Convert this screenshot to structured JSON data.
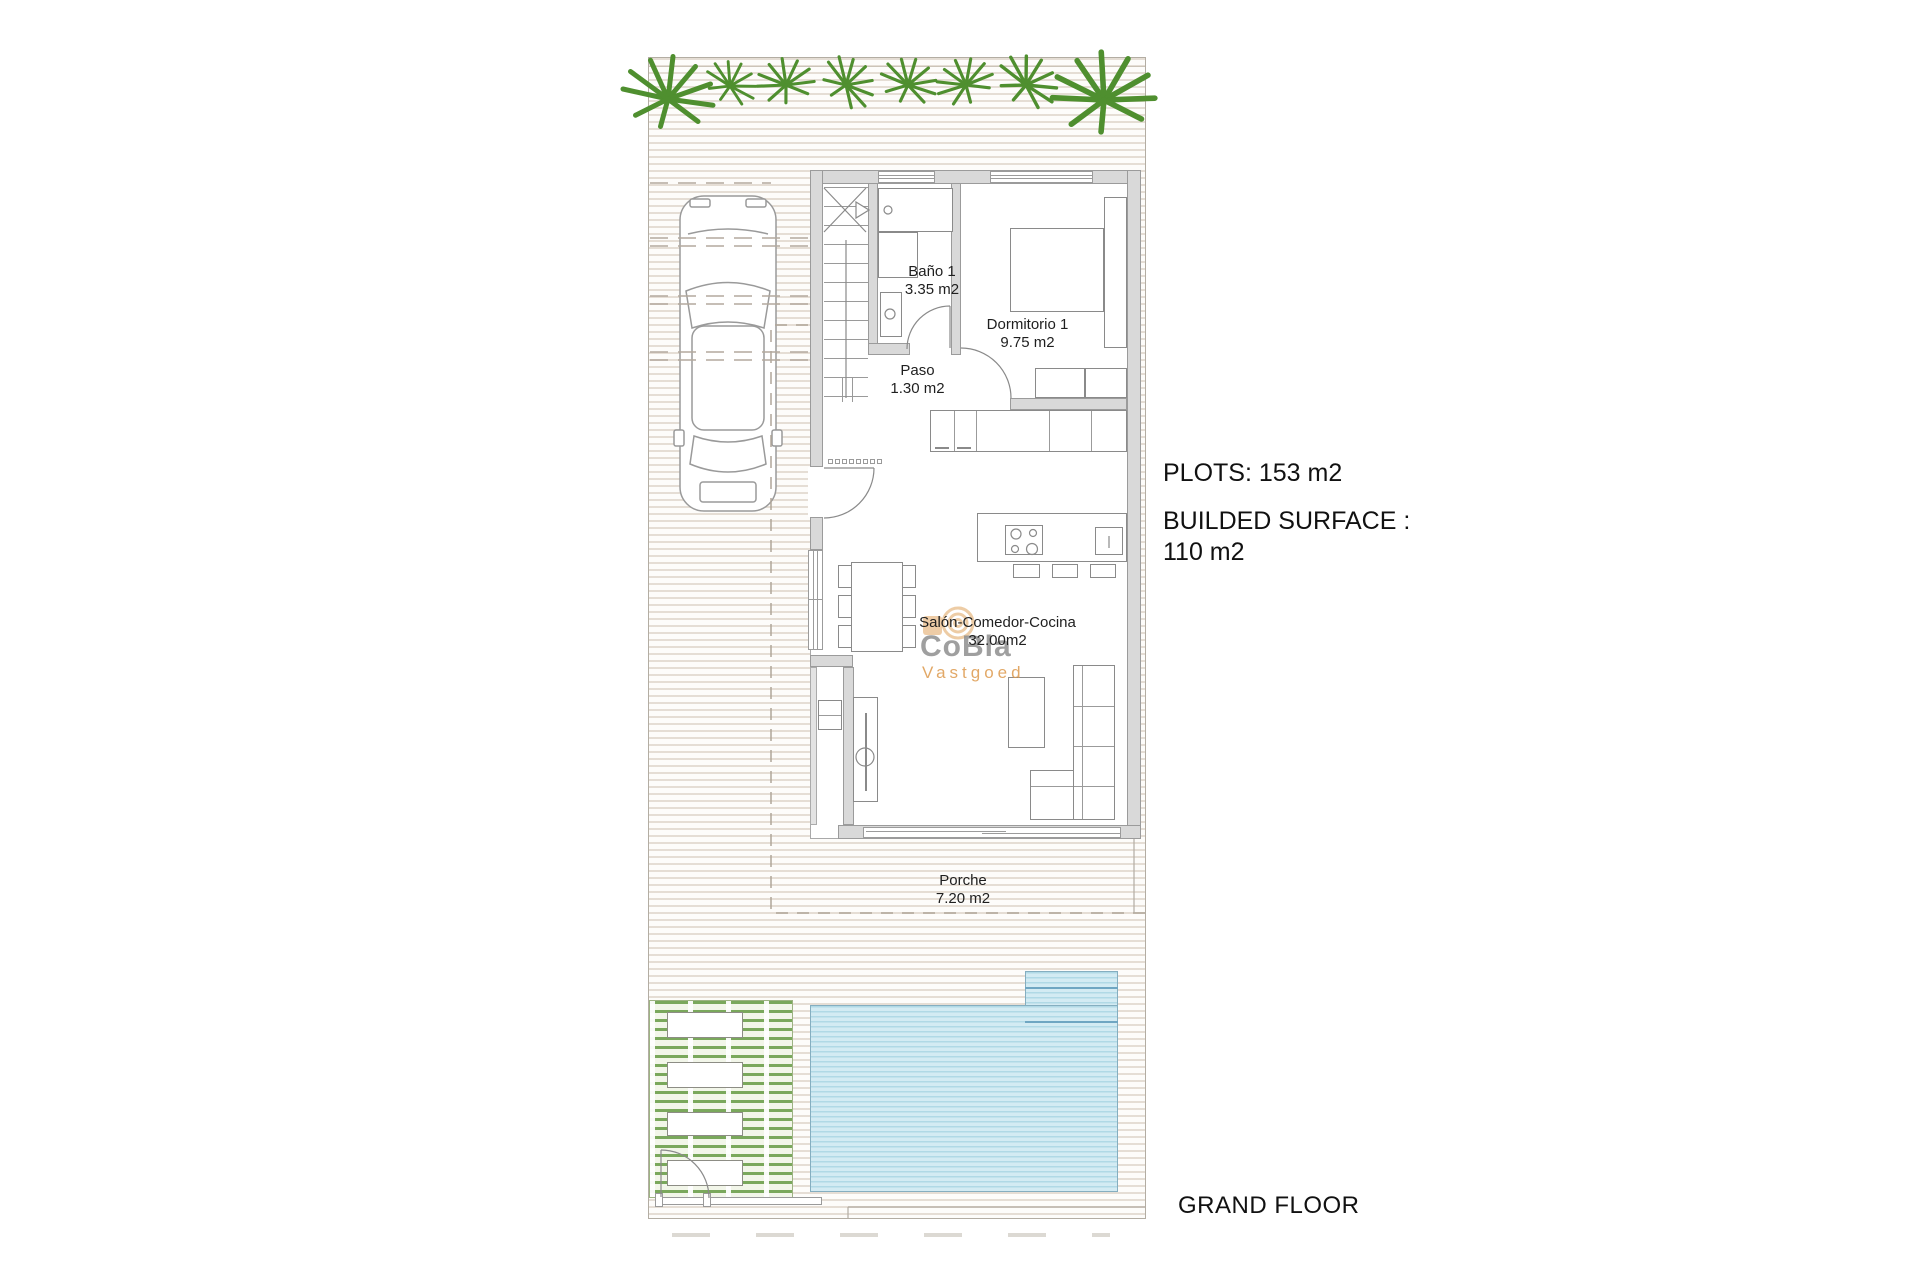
{
  "rooms": [
    {
      "name": "Baño 1",
      "area": "3.35 m2"
    },
    {
      "name": "Paso",
      "area": "1.30 m2"
    },
    {
      "name": "Dormitorio 1",
      "area": "9.75 m2"
    },
    {
      "name": "Salón-Comedor-Cocina",
      "area": "32.00m2"
    },
    {
      "name": "Porche",
      "area": "7.20 m2"
    }
  ],
  "annotations": {
    "plots": "PLOTS: 153 m2",
    "builded_line1": "BUILDED SURFACE :",
    "builded_line2": "110 m2",
    "floor_label": "GRAND FLOOR"
  },
  "watermark": {
    "brand": "CoBla",
    "subtitle": "Vastgoed"
  },
  "icons": {
    "palm": "palm-tree-icon",
    "car": "car-icon"
  },
  "colors": {
    "palm_green": "#4f8f2f",
    "garden_green": "#7aa85c",
    "pool_fill": "#d3ebf3",
    "pool_stripe": "#b0d9e6",
    "pool_dark_line": "#6fa6c2",
    "wall_gray": "#d9d9d9",
    "hatch_beige": "#cbbcac",
    "watermark_orange": "#dd9a4d",
    "watermark_gray": "#8f8f8f"
  }
}
